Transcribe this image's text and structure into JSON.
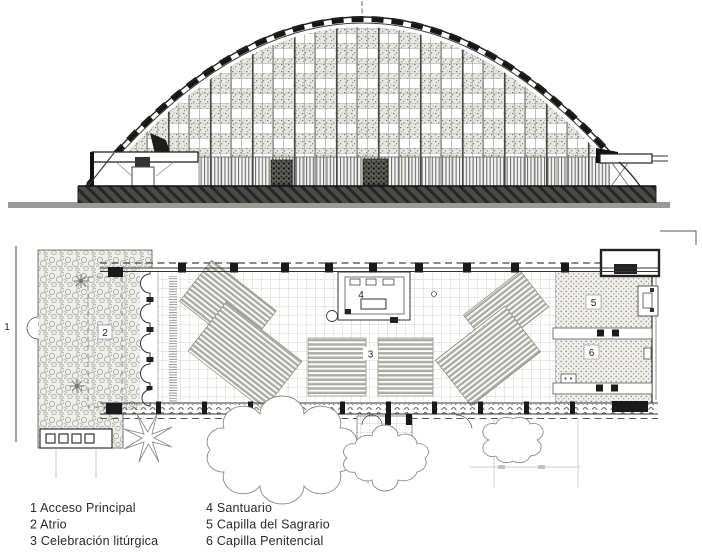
{
  "colors": {
    "ink": "#2a2a2a",
    "paper": "#ffffff",
    "texture_gray": "#8a8a8a",
    "plinth_dark": "#3f3f3d"
  },
  "plan": {
    "labels": {
      "access": "1",
      "atrio": "2",
      "liturgia": "3",
      "santuario": "4",
      "sagrario": "5",
      "penitencial": "6"
    }
  },
  "legend": {
    "col1": [
      "1 Acceso Principal",
      "2 Atrio",
      "3 Celebración litúrgica"
    ],
    "col2": [
      "4 Santuario",
      "5 Capilla del Sagrario",
      "6 Capilla Penitencial"
    ]
  }
}
